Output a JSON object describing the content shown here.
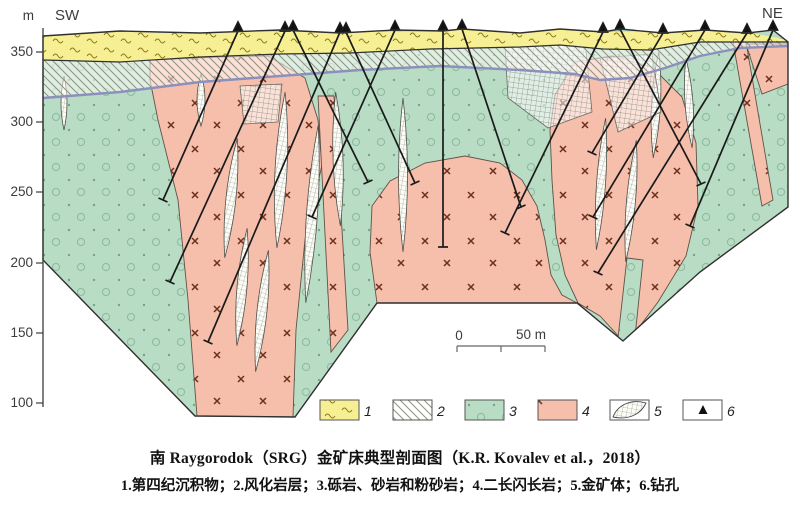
{
  "figure": {
    "left_label": "SW",
    "right_label": "NE",
    "axis_unit": "m",
    "axis_ticks": [
      "350",
      "300",
      "250",
      "200",
      "150",
      "100"
    ],
    "scale": {
      "zero": "0",
      "fifty": "50 m"
    },
    "legend_numbers": [
      "1",
      "2",
      "3",
      "4",
      "5",
      "6"
    ],
    "legend_items": [
      {
        "number": "1",
        "name": "第四纪沉积物"
      },
      {
        "number": "2",
        "name": "风化岩层"
      },
      {
        "number": "3",
        "name": "砾岩、砂岩和粉砂岩"
      },
      {
        "number": "4",
        "name": "二长闪长岩"
      },
      {
        "number": "5",
        "name": "金矿体"
      },
      {
        "number": "6",
        "name": "钻孔"
      }
    ],
    "captions": {
      "title": "南 Raygorodok（SRG）金矿床典型剖面图（K.R. Kovalev et al.，2018）",
      "legend_line": "1.第四纪沉积物；2.风化岩层；3.砾岩、砂岩和粉砂岩；4.二长闪长岩；5.金矿体；6.钻孔"
    },
    "colors": {
      "quaternary_yellow": "#f7ef93",
      "sediment_green": "#b9dcc5",
      "monzodiorite_pink": "#f5bfab",
      "weathering_boundary_purple": "#8b90bd",
      "drill_black": "#1a1a1a"
    }
  }
}
